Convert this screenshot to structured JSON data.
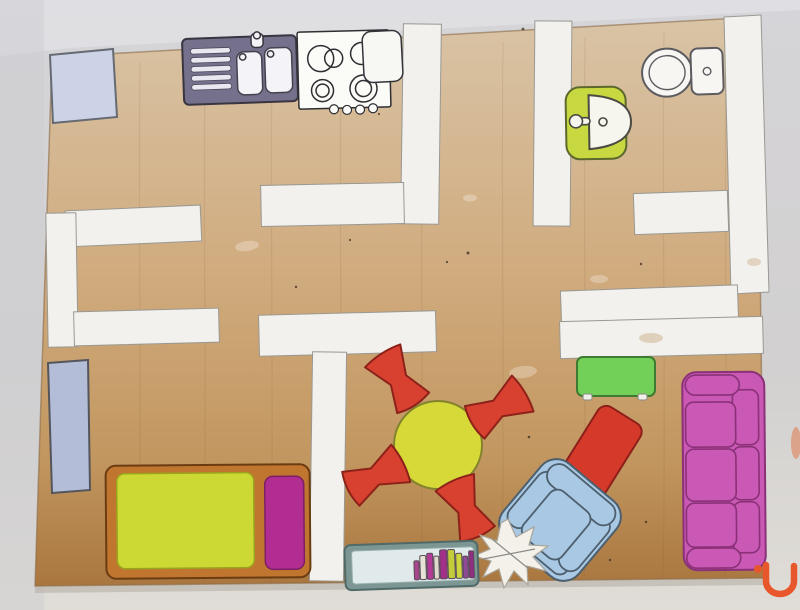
{
  "photo": {
    "background_top": "#d5d4d8",
    "background_mid": "#d2d0d0",
    "background_bottom": "#e0ddd7",
    "highlight": "#eae9ed",
    "left_shade": "#cdccd0",
    "orange_smudge": "#e07a4a",
    "board_shadow": "#b0a89c"
  },
  "board": {
    "wood_light": "#d9c4a6",
    "wood_mid": "#d0ab7e",
    "wood_dark": "#c2965f",
    "wood_deep": "#a9763f",
    "edge": "#8a6a46",
    "speck": "#3a2e1f",
    "grain": "#7a5632",
    "stain": "#cbb089"
  },
  "walls": {
    "fill": "#f2f1ed"
  },
  "kitchen": {
    "fridge_fill": "#ccd3e6",
    "unit_fill": "#75718c",
    "drainboard": "#e9e7f0",
    "bowl": "#f4f3f7",
    "stove_fill": "#fbfbf8",
    "counter_fill": "#f7f7f4"
  },
  "bathroom": {
    "toilet_fill": "#f7f6f2",
    "basin_counter": "#c8d841",
    "basin_bowl": "#f6f5ee"
  },
  "bedroom": {
    "door_panel": "#b3bdd8",
    "frame": "#c0762f",
    "mattress": "#ccd934",
    "pillow": "#b12d92"
  },
  "dining": {
    "table": "#d6d938",
    "chair": "#d8402f"
  },
  "living": {
    "side_table": "#72cf58",
    "side_table_foot": "#f0efe9",
    "ottoman": "#d5392a",
    "armchair": "#a9c8e3",
    "sofa": "#c959b4",
    "star": "#f4f1ea",
    "bookshelf_frame": "#7c9693",
    "bookshelf_inner": "#e0eaea",
    "books": [
      "#a8468e",
      "#e6e2d6",
      "#b53a98",
      "#ded9cc",
      "#a2308a",
      "#c3cd3b",
      "#ccd63e",
      "#8e4a96",
      "#8e2f80"
    ]
  },
  "logo": {
    "color": "#e8562c"
  }
}
